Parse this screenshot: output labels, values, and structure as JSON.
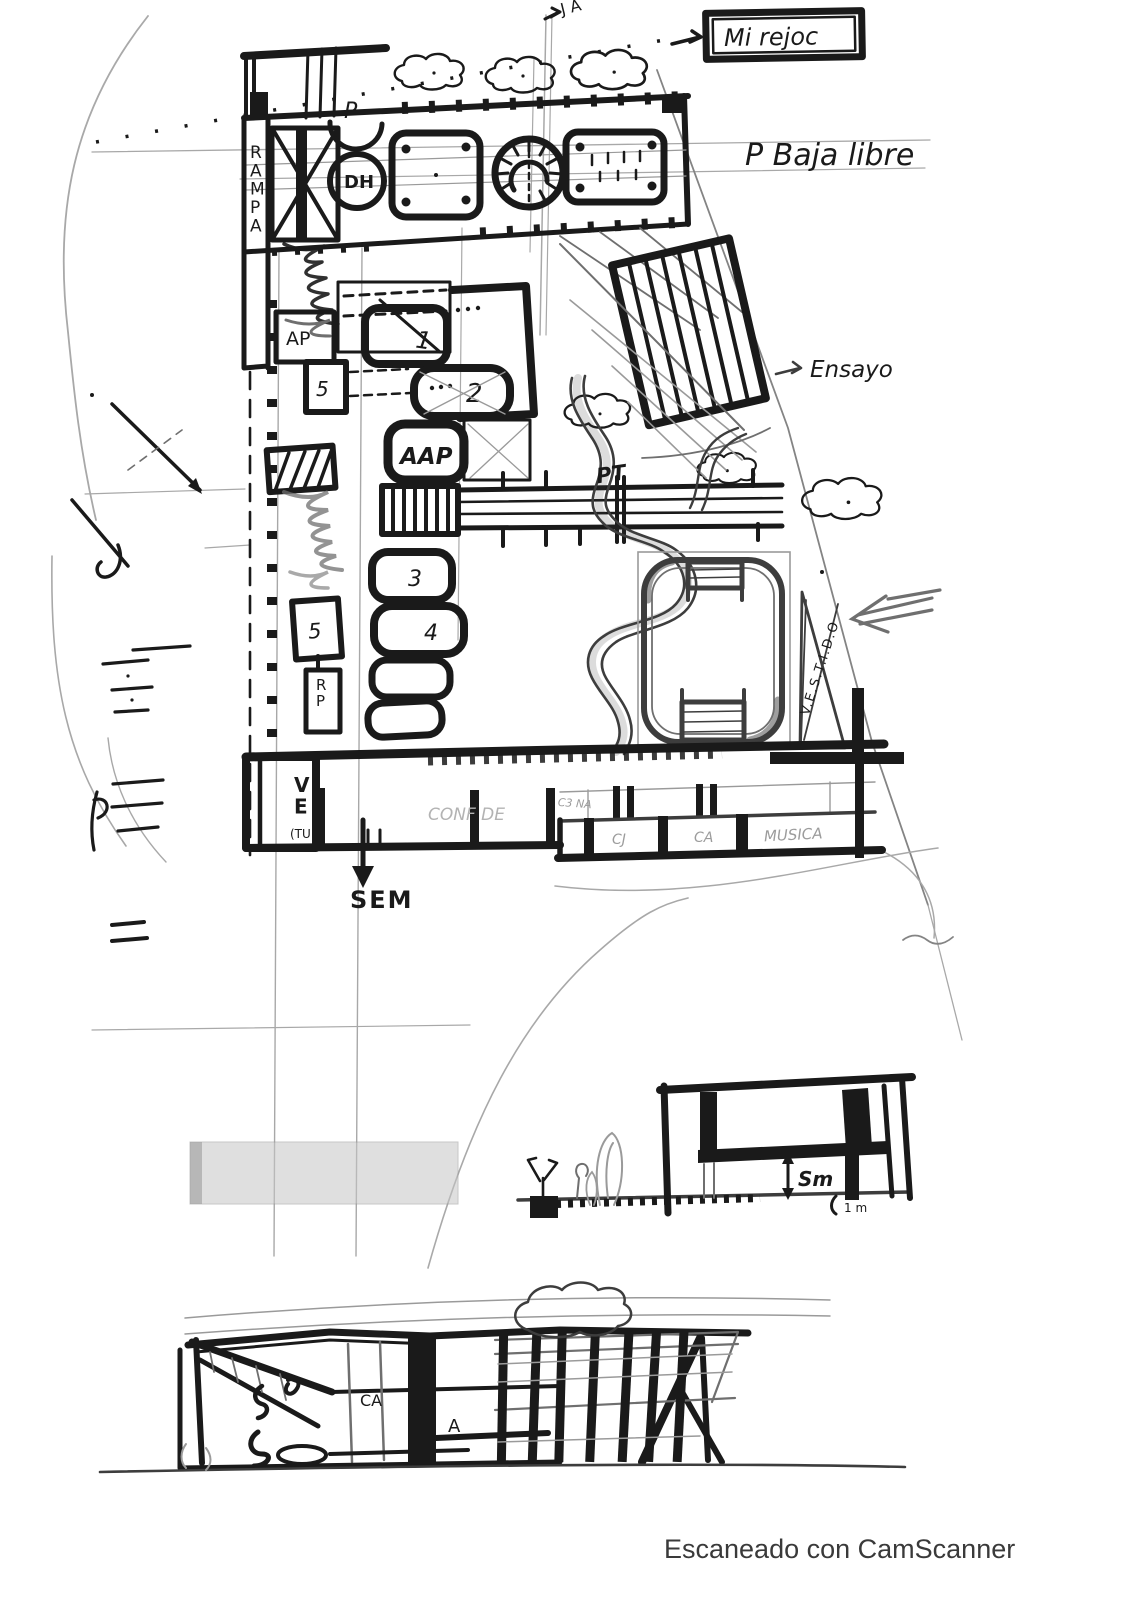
{
  "plan": {
    "annotation_box": "Mi rejoc",
    "floor_note": "P Baja libre",
    "top_mark": "J A",
    "ramp_label": "RAMPA",
    "stair_circle_label": "DH",
    "p_small": "P",
    "pt_label": "PT",
    "ensayo_label": "Ensayo",
    "vestidos_label": "V.E.S.T.I.D.O",
    "sem_label": "SEM",
    "rooms": {
      "ap": "AP",
      "aap": "AAP",
      "r1": "1",
      "r2": "2",
      "r3": "3",
      "r4": "4",
      "r5": "5",
      "rp": "RP"
    },
    "vestuario": {
      "line1": "VE",
      "line2": "(TU"
    },
    "faint_labels": {
      "confide": "CONF DE",
      "note": "C3 NA"
    },
    "lower_rooms": {
      "cj": "CJ",
      "ca": "CA",
      "musica": "MUSICA"
    }
  },
  "section": {
    "height_label": "Sm",
    "base_label": "1 m"
  },
  "elevation": {
    "ca_label": "CA",
    "a_label": "A"
  },
  "footer": {
    "scanner_note": "Escaneado con CamScanner"
  },
  "colors": {
    "ink": "#1a1a1a",
    "pencil": "#9a9a9a",
    "charcoal": "#3d3d3d",
    "footer": "#3a3a3a"
  }
}
